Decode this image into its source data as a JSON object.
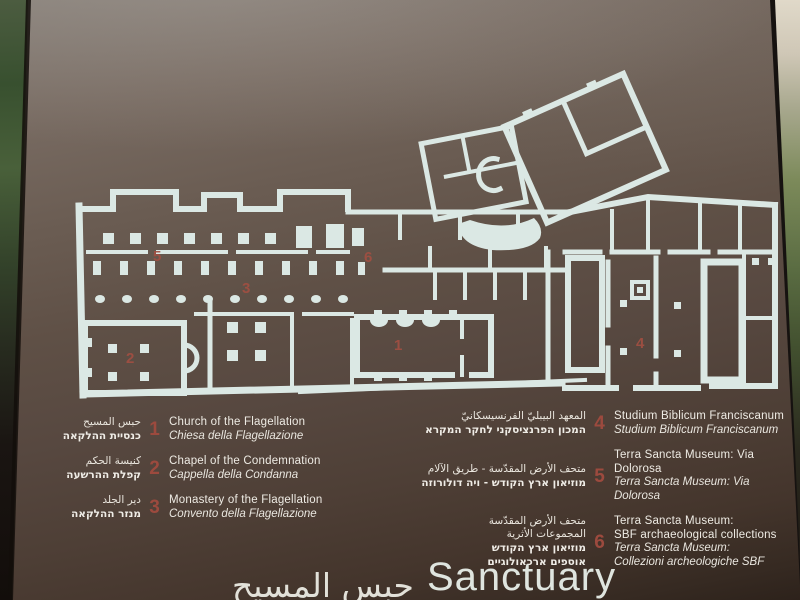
{
  "sign": {
    "heading": {
      "arabic": "حبس المسيح",
      "english": "Sanctuary"
    },
    "legend_left": {
      "items": [
        {
          "number": "1",
          "arabic": "حبس المسيح",
          "hebrew": "כנסיית ההלקאה",
          "english": "Church of the Flagellation",
          "italian": "Chiesa della Flagellazione"
        },
        {
          "number": "2",
          "arabic": "كنيسة الحكم",
          "hebrew": "קפלת ההרשעה",
          "english": "Chapel of the Condemnation",
          "italian": "Cappella della Condanna"
        },
        {
          "number": "3",
          "arabic": "دير الجلد",
          "hebrew": "מנזר ההלקאה",
          "english": "Monastery of the Flagellation",
          "italian": "Convento della Flagellazione"
        }
      ]
    },
    "legend_right": {
      "items": [
        {
          "number": "4",
          "arabic": "المعهد البيبليّ الفرنسيسكانيّ",
          "hebrew": "המכון הפרנציסקני לחקר המקרא",
          "english": "Studium Biblicum Franciscanum",
          "italian": "Studium Biblicum Franciscanum"
        },
        {
          "number": "5",
          "arabic": "متحف الأرض المقدّسة - طريق الآلام",
          "hebrew": "מוזיאון ארץ הקודש - ויה דולורוזה",
          "english": "Terra Sancta Museum: Via Dolorosa",
          "italian": "Terra Sancta Museum: Via Dolorosa"
        },
        {
          "number": "6",
          "arabic": "متحف الأرض المقدّسة",
          "arabic2": "المجموعات الأثرية",
          "hebrew": "מוזיאון ארץ הקודש",
          "hebrew2": "אוספים ארכאולוגיים",
          "english": "Terra Sancta Museum:",
          "english2": "SBF archaeological collections",
          "italian": "Terra Sancta Museum:",
          "italian2": "Collezioni archeologiche SBF"
        }
      ]
    },
    "colors": {
      "sign_brown": "#574840",
      "plan_walls": "#dbe8e4",
      "marker_red": "#9c4a3e",
      "legend_text": "#ece9e2"
    }
  }
}
